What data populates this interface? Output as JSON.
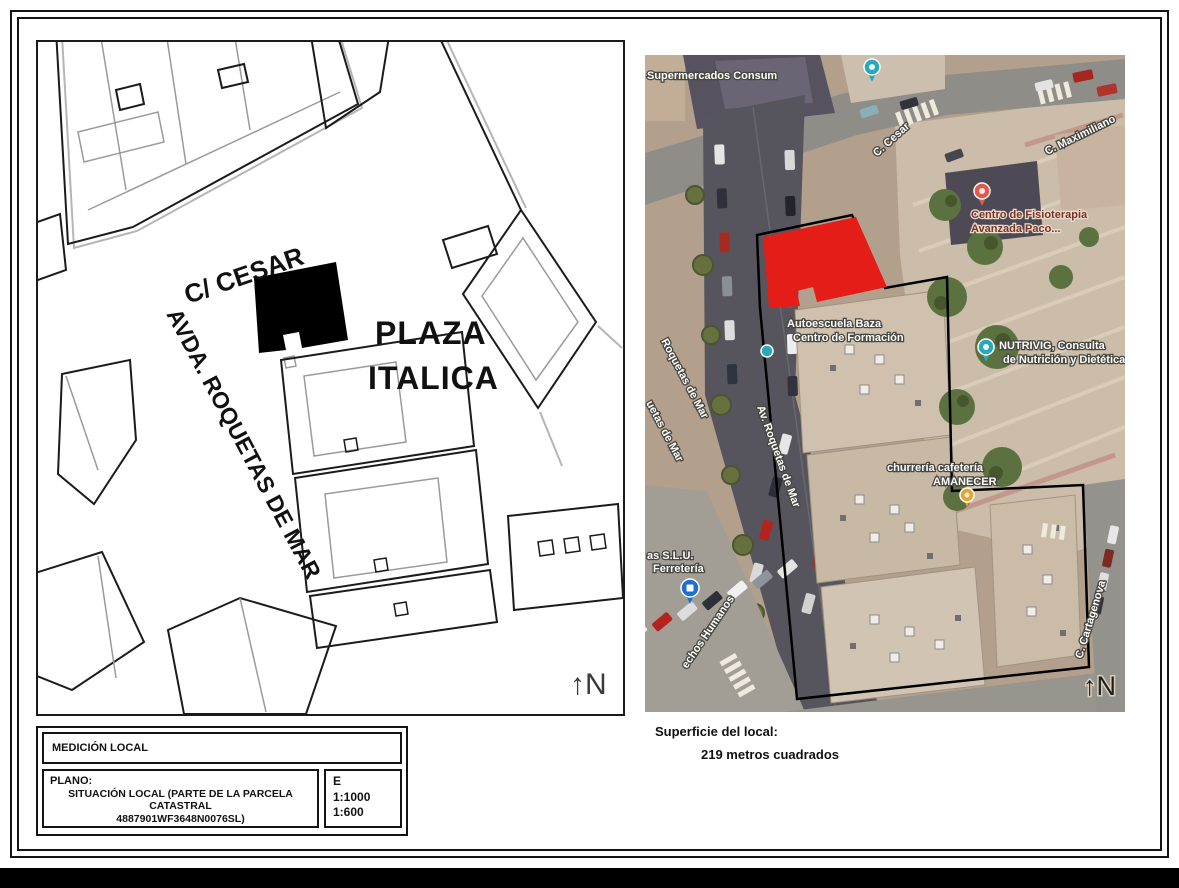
{
  "page": {
    "background": "#ffffff",
    "frame_color": "#141414",
    "bottom_bar_color": "#000000"
  },
  "plan": {
    "street_cesar": "C/ CESAR",
    "plaza_line1": "PLAZA",
    "plaza_line2": "ITALICA",
    "avenue": "AVDA. ROQUETAS DE MAR",
    "north": "↑N",
    "subject_fill": "#000000"
  },
  "title_block": {
    "project": "MEDICIÓN LOCAL",
    "plano_label": "PLANO:",
    "plano_line1": "SITUACIÓN LOCAL (PARTE DE LA PARCELA CATASTRAL",
    "plano_line2": "4887901WF3648N0076SL)",
    "scale_letter": "E",
    "scale_1": "1:1000",
    "scale_2": "1:600"
  },
  "map": {
    "subject_fill": "#e41d18",
    "boundary_color": "#000000",
    "labels": {
      "supermercados": "Supermercados Consum",
      "c_cesar": "C. Cesar",
      "c_maximiliano": "C. Maximiliano",
      "fisioterapia_1": "Centro de Fisioterapia",
      "fisioterapia_2": "Avanzada Paco...",
      "autoescuela_1": "Autoescuela Baza",
      "autoescuela_2": "Centro de Formación",
      "nutrivig_1": "NUTRIVIG, Consulta",
      "nutrivig_2": "de Nutrición y Dietética",
      "churreria_1": "churrería cafetería",
      "churreria_2": "AMANECER",
      "av_roquetas": "Av. Roquetas de Mar",
      "roquetas_partial_1": "Roquetas de Mar",
      "roquetas_partial_2": "uetas de Mar",
      "slu_1": "as S.L.U.",
      "slu_2": "Ferretería",
      "humanos": "echos Humanos",
      "cartagenova": "C. Cartagenova",
      "north": "↑N"
    },
    "pin_colors": {
      "teal": "#2aa7b8",
      "red": "#e2594a",
      "yellow": "#e3a52f",
      "blue": "#1e6fd0"
    }
  },
  "surface": {
    "title": "Superficie del local:",
    "value": "219 metros cuadrados"
  }
}
